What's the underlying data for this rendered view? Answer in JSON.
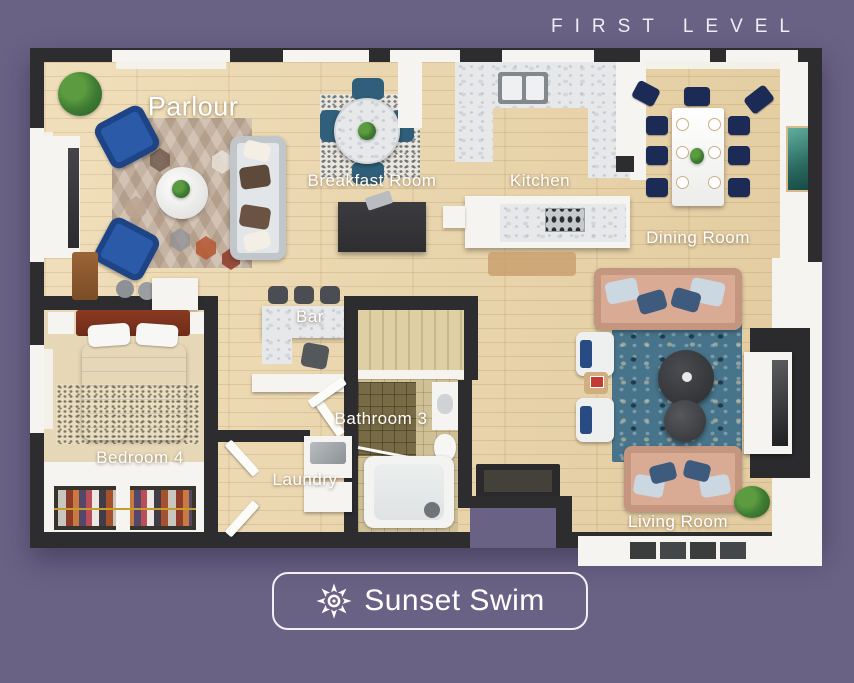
{
  "header": {
    "level_label": "FIRST LEVEL"
  },
  "rooms": {
    "parlour": {
      "label": "Parlour"
    },
    "breakfast_room": {
      "label": "Breakfast Room"
    },
    "kitchen": {
      "label": "Kitchen"
    },
    "dining_room": {
      "label": "Dining Room"
    },
    "bar": {
      "label": "Bar"
    },
    "bathroom_3": {
      "label": "Bathroom 3"
    },
    "laundry": {
      "label": "Laundry"
    },
    "bedroom_4": {
      "label": "Bedroom 4"
    },
    "living_room": {
      "label": "Living Room"
    }
  },
  "branding": {
    "name": "Sunset Swim",
    "icon": "sunburst-icon"
  },
  "colors": {
    "background": "#6a6285",
    "wall": "#2d2d30",
    "wood_floor": "#ead7b0",
    "marble": "#e7e8ea",
    "navy_chair": "#1c2b55",
    "blue_armchair": "#2b5ba8",
    "teal_rug": "#47748a",
    "tan_sofa": "#d9ab94",
    "stairs": "#decfa5",
    "label_text": "#ffffff"
  }
}
